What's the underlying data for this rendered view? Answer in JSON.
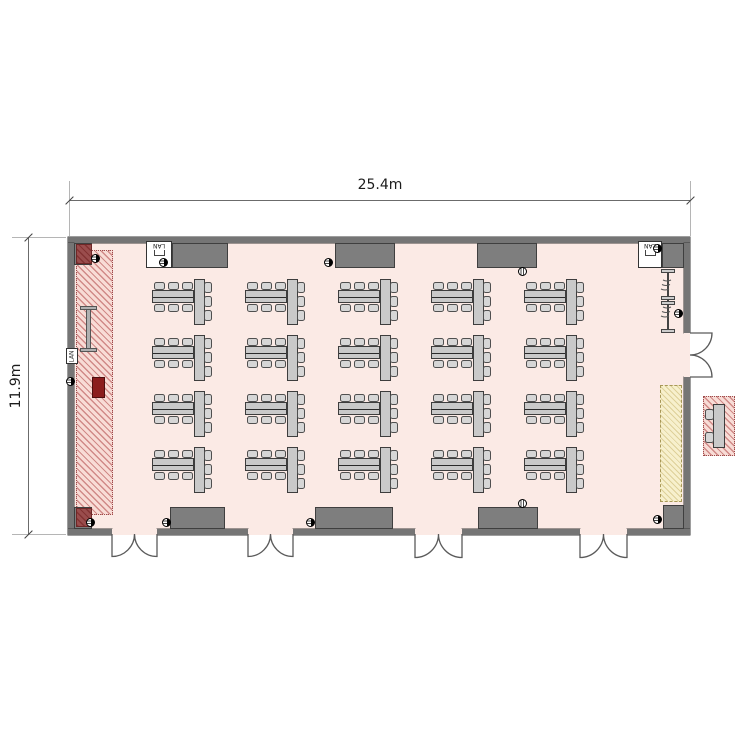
{
  "plan": {
    "type": "banquet-hall-floor-plan",
    "dimensions": {
      "width_label": "25.4m",
      "height_label": "11.9m"
    },
    "lan_labels": [
      "LAN",
      "LAN",
      "LAN"
    ],
    "seating": {
      "rows": 4,
      "columns": 5,
      "table_groups": 20,
      "long_tables_per_group": 2,
      "end_tables_per_group": 1,
      "chairs_per_group": 9
    },
    "features": {
      "stage_strip": "red hatched zone on left wall",
      "screen_symbol": 1,
      "podium": 1,
      "double_doors_bottom": 4,
      "double_doors_right": 1,
      "movable_partition_track": 1,
      "storage_strip": "yellow hatched zone on right wall",
      "wall_outlets": 10,
      "floor_outlets": 2,
      "annex": {
        "tables": 1,
        "chairs": 2
      }
    },
    "colors": {
      "floor": "#fbeae5",
      "wall": "#757575",
      "table": "#c9c9c9",
      "stage_hatch": "#b04646",
      "corner_accent": "#9a4d4d",
      "podium": "#8b1d1d",
      "storage_yellow": "#f7f0cd"
    }
  }
}
